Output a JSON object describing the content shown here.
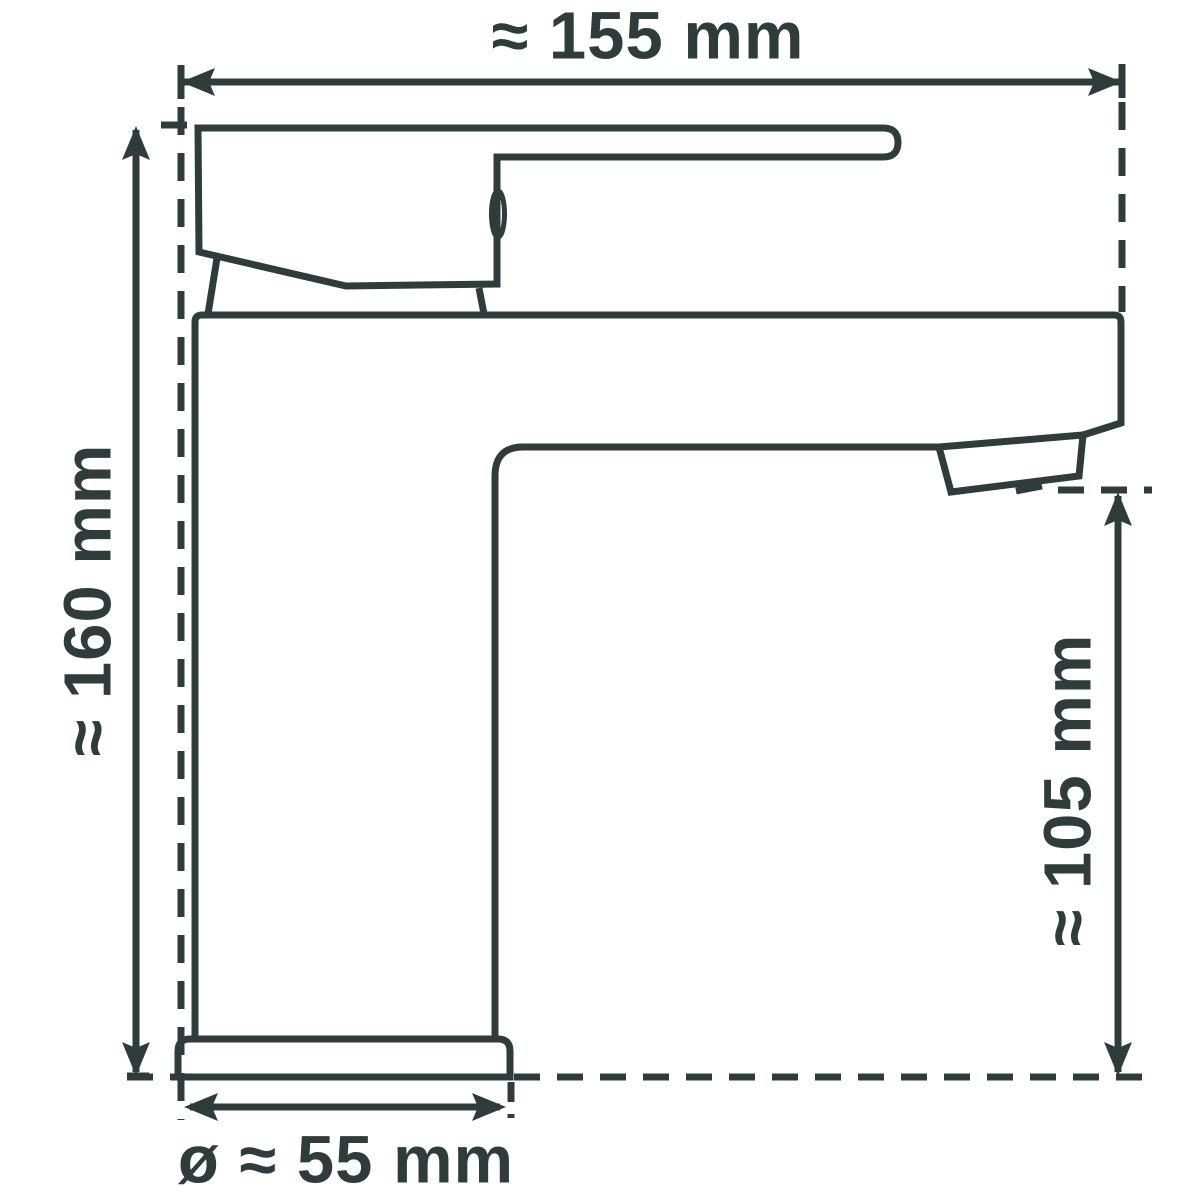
{
  "drawing": {
    "background_color": "#ffffff",
    "line_color": "#2f3c3a",
    "subject": "basin-mixer-faucet-side-view",
    "dimensions": {
      "width": {
        "label": "≈ 155 mm",
        "value_mm": 155,
        "approx": true
      },
      "height": {
        "label": "≈ 160 mm",
        "value_mm": 160,
        "approx": true
      },
      "spout_height": {
        "label": "≈ 105 mm",
        "value_mm": 105,
        "approx": true
      },
      "base_diameter": {
        "label": "ø ≈ 55 mm",
        "value_mm": 55,
        "approx": true
      }
    }
  }
}
